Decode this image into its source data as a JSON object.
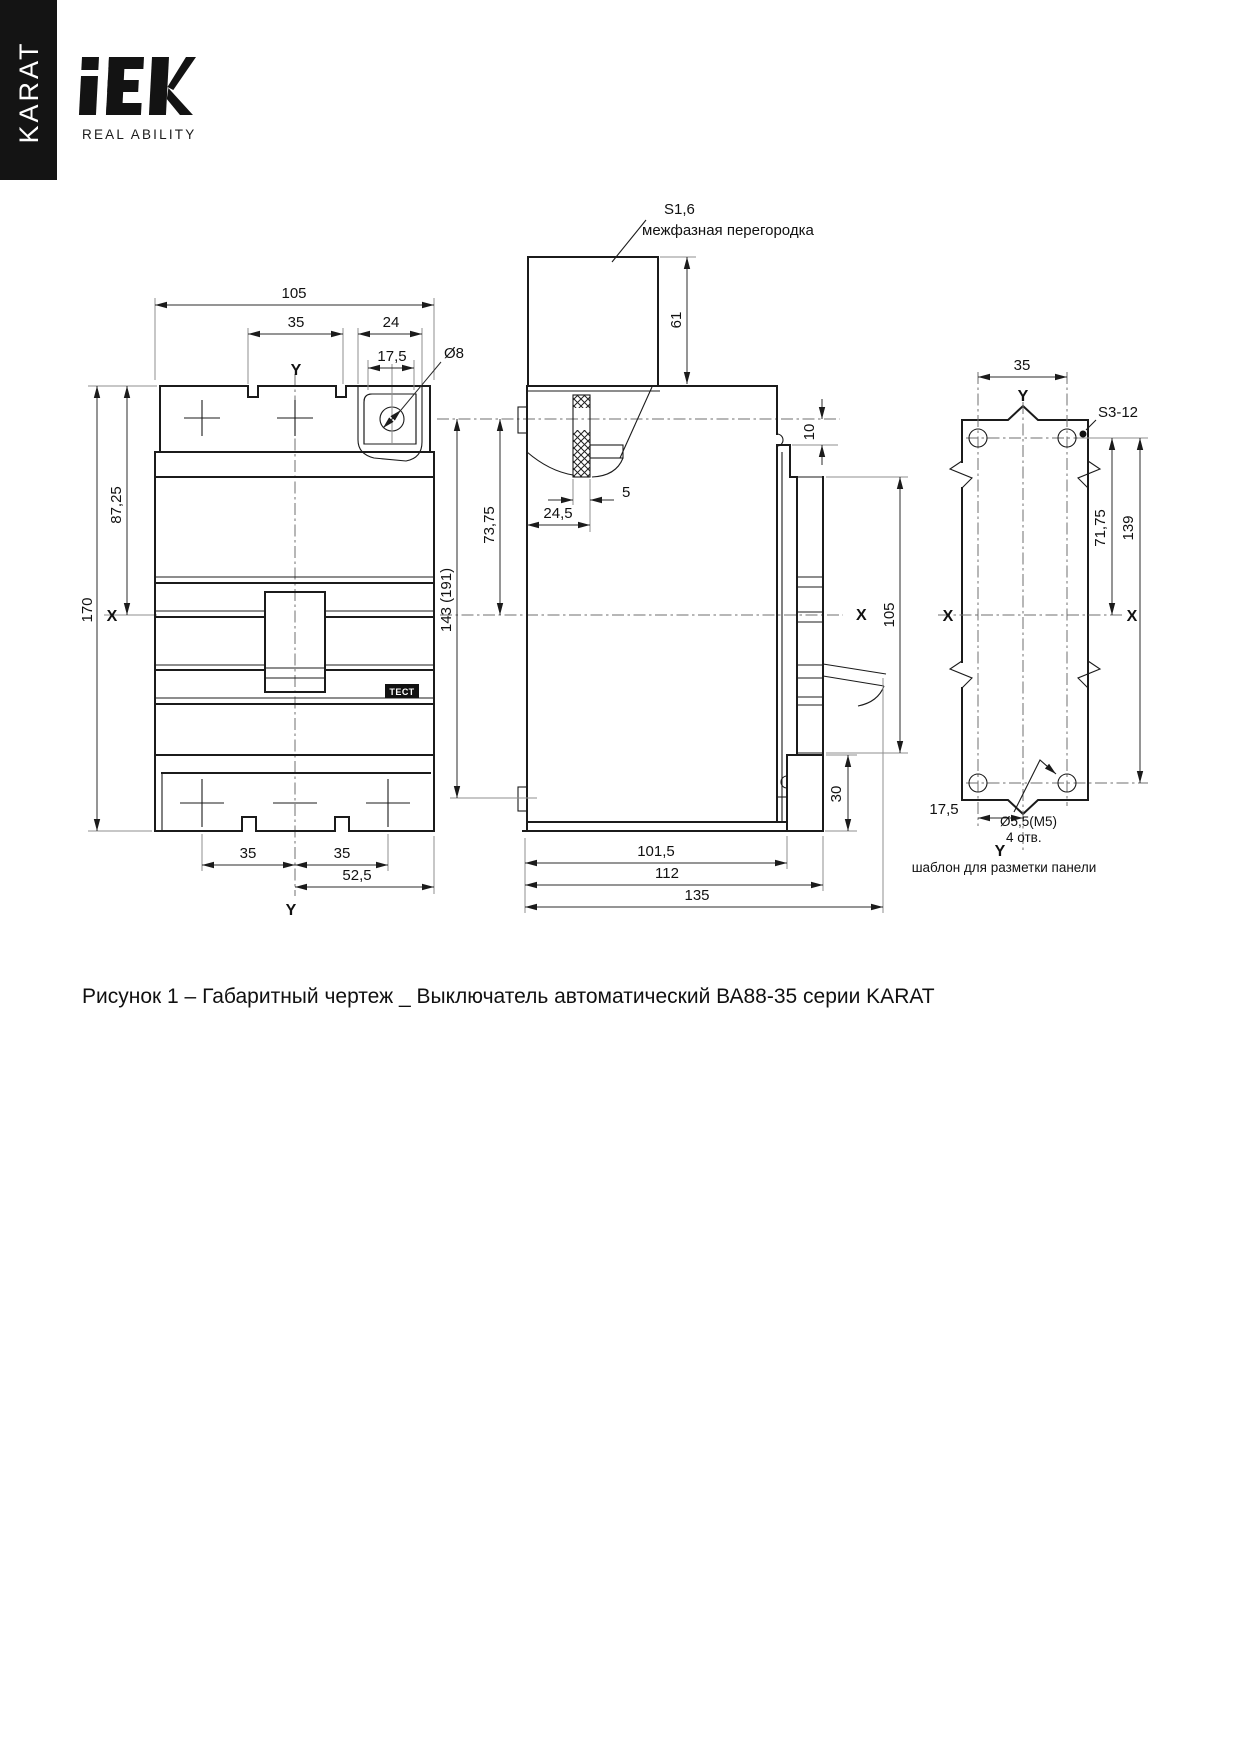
{
  "sidebar": {
    "series": "KARAT"
  },
  "brand": {
    "logo": "iEK",
    "tagline": "REAL ABILITY"
  },
  "figure_caption": "Рисунок 1 – Габаритный чертеж _ Выключатель автоматический ВА88-35 серии KARAT",
  "front_view": {
    "dim_overall_width": "105",
    "dim_pole_pitch": "35",
    "dim_pad_width": "24",
    "dim_hole_offset": "17,5",
    "dim_hole_dia": "Ø8",
    "dim_overall_height": "170",
    "dim_top_to_axis": "87,25",
    "dim_pitch_left": "35",
    "dim_pitch_right": "35",
    "dim_axis_to_edge": "52,5",
    "axis_x": "X",
    "axis_y_top": "Y",
    "axis_y_bottom": "Y",
    "test_button": "ТЕСТ"
  },
  "side_view": {
    "barrier_thickness": "S1,6",
    "barrier_label": "межфазная перегородка",
    "dim_barrier_height": "61",
    "dim_axes_span": "143 (191)",
    "dim_front_to_axis": "73,75",
    "dim_barrier_pos": "24,5",
    "dim_barrier_thk": "5",
    "dim_step": "10",
    "dim_panel_height": "105",
    "dim_foot_height": "30",
    "dim_base": "101,5",
    "dim_body_depth": "112",
    "dim_overall_depth": "135",
    "axis_x": "X"
  },
  "template_view": {
    "dim_hole_pitch_x": "35",
    "dim_axis_to_holes": "71,75",
    "dim_hole_pitch_y": "139",
    "dim_half_pitch": "17,5",
    "hole_spec": "Ø5,5(M5)",
    "hole_count": "4 отв.",
    "panel_spec": "S3-12",
    "axis_x_left": "X",
    "axis_x_right": "X",
    "axis_y_top": "Y",
    "axis_y_bottom": "Y",
    "note": "шаблон для разметки панели"
  }
}
